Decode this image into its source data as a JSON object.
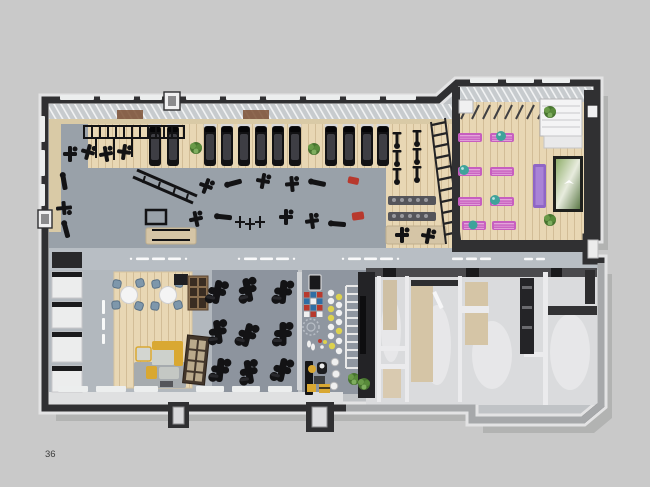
{
  "page": {
    "number": "36"
  },
  "palette": {
    "page_bg": "#c9c9c9",
    "building_shadow": "#b2b3b2",
    "wall_dark": "#303032",
    "wall_gray": "#a6a8aa",
    "wall_white": "#ebebed",
    "rim_light": "#e3e3e4",
    "floor_gym": "#99a1a9",
    "floor_corridor": "#b8bec4",
    "floor_cardio": "#8d949e",
    "floor_functional": "#8f96a0",
    "floor_lounge": "#b2b8be",
    "floor_wood": "#e8d7b4",
    "wood_line": "#d2bd97",
    "beige": "#d5c5a6",
    "locker_bg": "#dadbdd",
    "equipment_black": "#141416",
    "mat_pink": "#c75ec0",
    "mat_purple": "#8f66c6",
    "ball_teal": "#3fa39a",
    "sofa_yellow": "#d9a832",
    "chair_blue": "#7e97ab",
    "accent_red": "#b8392d",
    "accent_blue": "#2f6ea5",
    "accent_yellow": "#ddd24e",
    "plant_green": "#4e7d3a",
    "page_number_color": "#3c3c3c"
  }
}
